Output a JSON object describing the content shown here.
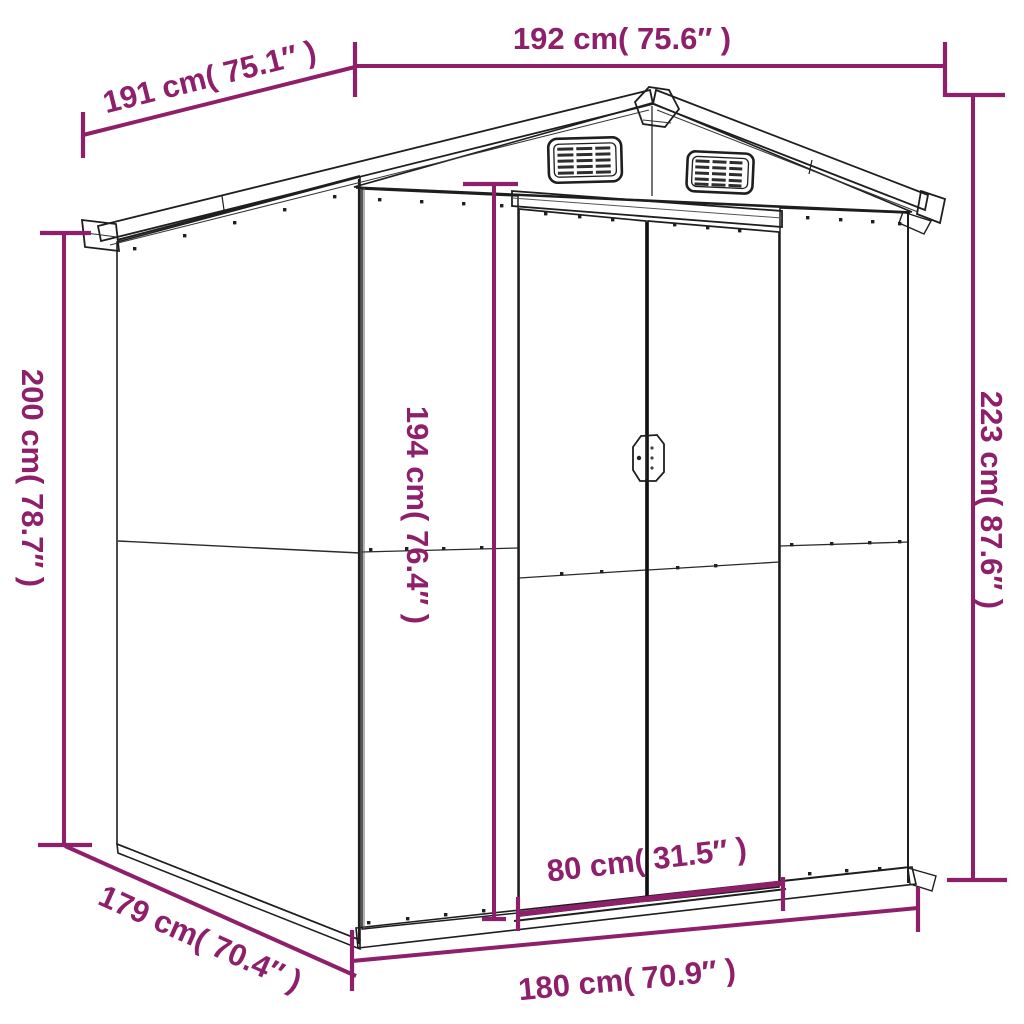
{
  "title": "Garden shed dimension diagram",
  "colors": {
    "dimension_annotation": "#8E1F6B",
    "outline": "#1E1E1E",
    "background": "#FFFFFF"
  },
  "product": {
    "type": "garden shed",
    "features": [
      "gabled roof",
      "two louvered roof vents",
      "double sliding doors",
      "corrugated steel panels"
    ]
  },
  "dimensions": {
    "roof_depth_left": {
      "label": "191 cm( 75.1″ )",
      "cm": 191,
      "inches": 75.1
    },
    "roof_width_top": {
      "label": "192 cm( 75.6″ )",
      "cm": 192,
      "inches": 75.6
    },
    "wall_height_left": {
      "label": "200 cm( 78.7″ )",
      "cm": 200,
      "inches": 78.7
    },
    "door_height_center": {
      "label": "194 cm( 76.4″ )",
      "cm": 194,
      "inches": 76.4
    },
    "total_height_right": {
      "label": "223 cm( 87.6″ )",
      "cm": 223,
      "inches": 87.6
    },
    "door_width": {
      "label": "80 cm( 31.5″ )",
      "cm": 80,
      "inches": 31.5
    },
    "base_width_front": {
      "label": "180 cm( 70.9″ )",
      "cm": 180,
      "inches": 70.9
    },
    "base_depth_side": {
      "label": "179 cm( 70.4″ )",
      "cm": 179,
      "inches": 70.4
    }
  }
}
